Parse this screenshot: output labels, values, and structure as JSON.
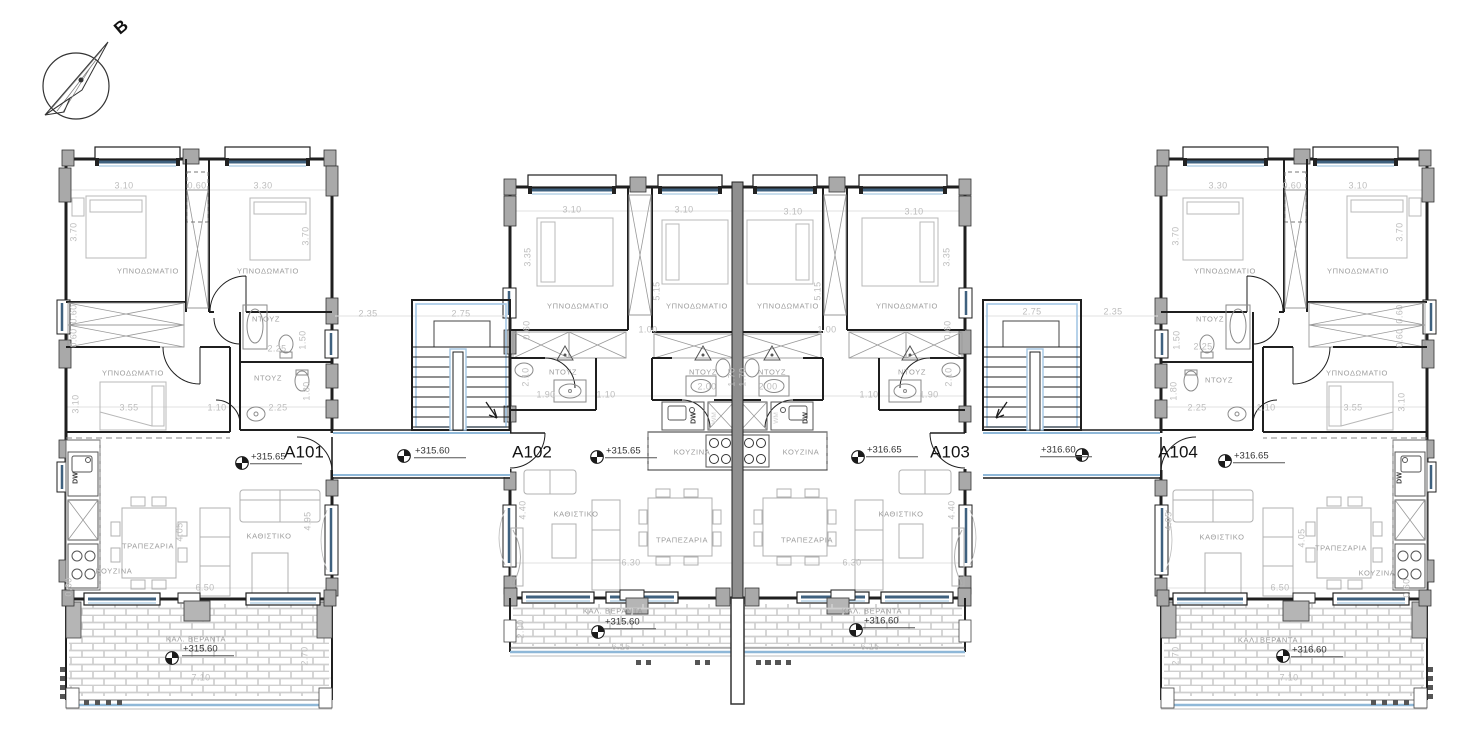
{
  "drawing": {
    "type": "architectural floor plan",
    "north_arrow_label": "B",
    "apartments": [
      {
        "id": "A101",
        "floor_level": "+315.65",
        "veranda_level": "+315.60"
      },
      {
        "id": "A102",
        "floor_level": "+315.65",
        "veranda_level": "+315.60"
      },
      {
        "id": "A103",
        "floor_level": "+316.65",
        "veranda_level": "+316.60"
      },
      {
        "id": "A104",
        "floor_level": "+316.65",
        "veranda_level": "+316.60"
      }
    ],
    "stairwells": [
      {
        "level": "+315.60"
      },
      {
        "level": "+316.60"
      }
    ],
    "room_names_used": [
      "ΥΠΝΟΔΩΜΑΤΙΟ",
      "ΝΤΟΥΖ",
      "ΚΟΥΖΙΝΑ",
      "ΤΡΑΠΕΖΑΡΙΑ",
      "ΚΑΘΙΣΤΙΚΟ",
      "ΚΑΛ. ΒΕΡΑΝΤΑ"
    ],
    "colors": {
      "wall": "#1f1f1f",
      "window_glazing": "#3f617f",
      "window_glazing_light": "#a9c9e2",
      "stair_outline": "#a3c6e4",
      "veranda_edge_blue": "#8fb8d8",
      "dimension_text": "#bdbdbd",
      "room_text": "#9c9c9c",
      "column_fill": "#a9a9a9"
    }
  },
  "labels": [
    {
      "t": "B",
      "x": 121,
      "y": 27,
      "c": "north"
    },
    {
      "t": "3.10",
      "x": 124,
      "y": 186,
      "c": "dim"
    },
    {
      "t": "0.60",
      "x": 197,
      "y": 186,
      "c": "dim"
    },
    {
      "t": "3.30",
      "x": 263,
      "y": 186,
      "c": "dim"
    },
    {
      "t": "3.70",
      "x": 74,
      "y": 232,
      "c": "dimv"
    },
    {
      "t": "3.70",
      "x": 306,
      "y": 236,
      "c": "dimv"
    },
    {
      "t": "ΥΠΝΟΔΩΜΑΤΙΟ",
      "x": 148,
      "y": 271,
      "c": "room"
    },
    {
      "t": "ΥΠΝΟΔΩΜΑΤΙΟ",
      "x": 268,
      "y": 271,
      "c": "room"
    },
    {
      "t": "ΝΤΟΥΖ",
      "x": 266,
      "y": 319,
      "c": "room"
    },
    {
      "t": "0.60",
      "x": 74,
      "y": 314,
      "c": "dimv"
    },
    {
      "t": "0.60",
      "x": 74,
      "y": 338,
      "c": "dimv"
    },
    {
      "t": "2.25",
      "x": 277,
      "y": 349,
      "c": "dim"
    },
    {
      "t": "1.50",
      "x": 303,
      "y": 340,
      "c": "dimv"
    },
    {
      "t": "ΥΠΝΟΔΩΜΑΤΙΟ",
      "x": 133,
      "y": 373,
      "c": "room"
    },
    {
      "t": "ΝΤΟΥΖ",
      "x": 268,
      "y": 378,
      "c": "room"
    },
    {
      "t": "3.55",
      "x": 129,
      "y": 408,
      "c": "dim"
    },
    {
      "t": "1.10",
      "x": 217,
      "y": 408,
      "c": "dim"
    },
    {
      "t": "2.25",
      "x": 278,
      "y": 408,
      "c": "dim"
    },
    {
      "t": "3.10",
      "x": 76,
      "y": 404,
      "c": "dimv"
    },
    {
      "t": "1.80",
      "x": 307,
      "y": 391,
      "c": "dimv"
    },
    {
      "t": "A101",
      "x": 304,
      "y": 452,
      "c": "apt"
    },
    {
      "t": "+315.65",
      "x": 250,
      "y": 458,
      "c": "level"
    },
    {
      "t": "ΤΡΑΠΕΖΑΡΙΑ",
      "x": 148,
      "y": 546,
      "c": "room"
    },
    {
      "t": "ΚΟΥΖΙΝΑ",
      "x": 114,
      "y": 571,
      "c": "room"
    },
    {
      "t": "ΚΑΘΙΣΤΙΚΟ",
      "x": 269,
      "y": 536,
      "c": "room"
    },
    {
      "t": "4.05",
      "x": 180,
      "y": 532,
      "c": "dimv"
    },
    {
      "t": "4.95",
      "x": 308,
      "y": 521,
      "c": "dimv"
    },
    {
      "t": "6.50",
      "x": 205,
      "y": 588,
      "c": "dim"
    },
    {
      "t": "0.60",
      "x": 69,
      "y": 587,
      "c": "dimv"
    },
    {
      "t": "DW",
      "x": 76,
      "y": 478,
      "c": "appl"
    },
    {
      "t": "ΚΑΛ. ΒΕΡΑΝΤΑ",
      "x": 196,
      "y": 639,
      "c": "room"
    },
    {
      "t": "+315.60",
      "x": 182,
      "y": 650,
      "c": "level"
    },
    {
      "t": "7.10",
      "x": 201,
      "y": 678,
      "c": "dim"
    },
    {
      "t": "2.70",
      "x": 305,
      "y": 656,
      "c": "dimv"
    },
    {
      "t": "2.35",
      "x": 368,
      "y": 314,
      "c": "dim"
    },
    {
      "t": "2.75",
      "x": 461,
      "y": 314,
      "c": "dim"
    },
    {
      "t": "+315.60",
      "x": 414,
      "y": 452,
      "c": "level"
    },
    {
      "t": "A102",
      "x": 532,
      "y": 452,
      "c": "apt"
    },
    {
      "t": "3.10",
      "x": 572,
      "y": 210,
      "c": "dim"
    },
    {
      "t": "3.10",
      "x": 684,
      "y": 210,
      "c": "dim"
    },
    {
      "t": "3.10",
      "x": 793,
      "y": 212,
      "c": "dim"
    },
    {
      "t": "3.10",
      "x": 914,
      "y": 212,
      "c": "dim"
    },
    {
      "t": "3.35",
      "x": 528,
      "y": 257,
      "c": "dimv"
    },
    {
      "t": "3.35",
      "x": 947,
      "y": 257,
      "c": "dimv"
    },
    {
      "t": "5.15",
      "x": 657,
      "y": 291,
      "c": "dimv"
    },
    {
      "t": "5.15",
      "x": 818,
      "y": 291,
      "c": "dimv"
    },
    {
      "t": "ΥΠΝΟΔΩΜΑΤΙΟ",
      "x": 578,
      "y": 306,
      "c": "room"
    },
    {
      "t": "ΥΠΝΟΔΩΜΑΤΙΟ",
      "x": 697,
      "y": 306,
      "c": "room"
    },
    {
      "t": "ΥΠΝΟΔΩΜΑΤΙΟ",
      "x": 788,
      "y": 306,
      "c": "room"
    },
    {
      "t": "ΥΠΝΟΔΩΜΑΤΙΟ",
      "x": 907,
      "y": 306,
      "c": "room"
    },
    {
      "t": "1.00",
      "x": 648,
      "y": 330,
      "c": "dim"
    },
    {
      "t": "1.00",
      "x": 827,
      "y": 330,
      "c": "dim"
    },
    {
      "t": "0.60",
      "x": 527,
      "y": 330,
      "c": "dimv"
    },
    {
      "t": "0.60",
      "x": 948,
      "y": 330,
      "c": "dimv"
    },
    {
      "t": "ΝΤΟΥΖ",
      "x": 563,
      "y": 372,
      "c": "room"
    },
    {
      "t": "ΝΤΟΥΖ",
      "x": 703,
      "y": 372,
      "c": "room"
    },
    {
      "t": "ΝΤΟΥΖ",
      "x": 772,
      "y": 372,
      "c": "room"
    },
    {
      "t": "ΝΤΟΥΖ",
      "x": 912,
      "y": 372,
      "c": "room"
    },
    {
      "t": "2.10",
      "x": 526,
      "y": 377,
      "c": "dimv"
    },
    {
      "t": "2.10",
      "x": 949,
      "y": 377,
      "c": "dimv"
    },
    {
      "t": "1.90",
      "x": 546,
      "y": 395,
      "c": "dim"
    },
    {
      "t": "1.90",
      "x": 929,
      "y": 395,
      "c": "dim"
    },
    {
      "t": "1.10",
      "x": 606,
      "y": 395,
      "c": "dim"
    },
    {
      "t": "1.10",
      "x": 869,
      "y": 395,
      "c": "dim"
    },
    {
      "t": "2.00",
      "x": 707,
      "y": 387,
      "c": "dim"
    },
    {
      "t": "2.00",
      "x": 768,
      "y": 387,
      "c": "dim"
    },
    {
      "t": "1.70",
      "x": 732,
      "y": 377,
      "c": "dimv"
    },
    {
      "t": "1.70",
      "x": 743,
      "y": 377,
      "c": "dimv"
    },
    {
      "t": "DW",
      "x": 694,
      "y": 418,
      "c": "appl"
    },
    {
      "t": "DW",
      "x": 806,
      "y": 418,
      "c": "appl"
    },
    {
      "t": "WM",
      "x": 715,
      "y": 418,
      "c": "applf"
    },
    {
      "t": "WM",
      "x": 777,
      "y": 418,
      "c": "applf"
    },
    {
      "t": "ΚΟΥΖΙΝΑ",
      "x": 692,
      "y": 452,
      "c": "room"
    },
    {
      "t": "ΚΟΥΖΙΝΑ",
      "x": 801,
      "y": 452,
      "c": "room"
    },
    {
      "t": "+315.65",
      "x": 605,
      "y": 452,
      "c": "level"
    },
    {
      "t": "+316.65",
      "x": 866,
      "y": 451,
      "c": "level"
    },
    {
      "t": "A103",
      "x": 950,
      "y": 452,
      "c": "apt"
    },
    {
      "t": "ΚΑΘΙΣΤΙΚΟ",
      "x": 576,
      "y": 514,
      "c": "room"
    },
    {
      "t": "ΚΑΘΙΣΤΙΚΟ",
      "x": 901,
      "y": 514,
      "c": "room"
    },
    {
      "t": "4.40",
      "x": 523,
      "y": 510,
      "c": "dimv"
    },
    {
      "t": "4.40",
      "x": 952,
      "y": 510,
      "c": "dimv"
    },
    {
      "t": "ΤΡΑΠΕΖΑΡΙΑ",
      "x": 682,
      "y": 540,
      "c": "room"
    },
    {
      "t": "ΤΡΑΠΕΖΑΡΙΑ",
      "x": 807,
      "y": 540,
      "c": "room"
    },
    {
      "t": "6.30",
      "x": 631,
      "y": 563,
      "c": "dim"
    },
    {
      "t": "6.30",
      "x": 852,
      "y": 563,
      "c": "dim"
    },
    {
      "t": "ΚΑΛ. ΒΕΡΑΝΤΑ",
      "x": 613,
      "y": 611,
      "c": "room"
    },
    {
      "t": "+315.60",
      "x": 604,
      "y": 623,
      "c": "level"
    },
    {
      "t": "6.15",
      "x": 621,
      "y": 647,
      "c": "dim"
    },
    {
      "t": "2.00",
      "x": 521,
      "y": 629,
      "c": "dimv"
    },
    {
      "t": "ΚΑΛ. ΒΕΡΑΝΤΑ",
      "x": 872,
      "y": 611,
      "c": "room"
    },
    {
      "t": "+316.60",
      "x": 863,
      "y": 622,
      "c": "level"
    },
    {
      "t": "6.15",
      "x": 870,
      "y": 647,
      "c": "dim"
    },
    {
      "t": "2.75",
      "x": 1032,
      "y": 312,
      "c": "dim"
    },
    {
      "t": "2.35",
      "x": 1113,
      "y": 312,
      "c": "dim"
    },
    {
      "t": "+316.60",
      "x": 1040,
      "y": 451,
      "c": "level"
    },
    {
      "t": "A104",
      "x": 1178,
      "y": 452,
      "c": "apt"
    },
    {
      "t": "3.30",
      "x": 1218,
      "y": 186,
      "c": "dim"
    },
    {
      "t": "0.60",
      "x": 1292,
      "y": 186,
      "c": "dim"
    },
    {
      "t": "3.10",
      "x": 1358,
      "y": 186,
      "c": "dim"
    },
    {
      "t": "3.70",
      "x": 1176,
      "y": 236,
      "c": "dimv"
    },
    {
      "t": "3.70",
      "x": 1400,
      "y": 232,
      "c": "dimv"
    },
    {
      "t": "ΥΠΝΟΔΩΜΑΤΙΟ",
      "x": 1225,
      "y": 271,
      "c": "room"
    },
    {
      "t": "ΥΠΝΟΔΩΜΑΤΙΟ",
      "x": 1358,
      "y": 271,
      "c": "room"
    },
    {
      "t": "ΝΤΟΥΖ",
      "x": 1210,
      "y": 319,
      "c": "room"
    },
    {
      "t": "0.60",
      "x": 1400,
      "y": 314,
      "c": "dimv"
    },
    {
      "t": "0.60",
      "x": 1400,
      "y": 338,
      "c": "dimv"
    },
    {
      "t": "2.25",
      "x": 1203,
      "y": 347,
      "c": "dim"
    },
    {
      "t": "1.50",
      "x": 1177,
      "y": 340,
      "c": "dimv"
    },
    {
      "t": "ΥΠΝΟΔΩΜΑΤΙΟ",
      "x": 1357,
      "y": 373,
      "c": "room"
    },
    {
      "t": "ΝΤΟΥΖ",
      "x": 1219,
      "y": 380,
      "c": "room"
    },
    {
      "t": "2.25",
      "x": 1197,
      "y": 408,
      "c": "dim"
    },
    {
      "t": "1.10",
      "x": 1266,
      "y": 408,
      "c": "dim"
    },
    {
      "t": "3.55",
      "x": 1353,
      "y": 408,
      "c": "dim"
    },
    {
      "t": "3.10",
      "x": 1402,
      "y": 402,
      "c": "dimv"
    },
    {
      "t": "1.80",
      "x": 1174,
      "y": 391,
      "c": "dimv"
    },
    {
      "t": "+316.65",
      "x": 1233,
      "y": 457,
      "c": "level"
    },
    {
      "t": "ΚΑΘΙΣΤΙΚΟ",
      "x": 1222,
      "y": 537,
      "c": "room"
    },
    {
      "t": "ΤΡΑΠΕΖΑΡΙΑ",
      "x": 1341,
      "y": 548,
      "c": "room"
    },
    {
      "t": "ΚΟΥΖΙΝΑ",
      "x": 1377,
      "y": 573,
      "c": "room"
    },
    {
      "t": "4.95",
      "x": 1169,
      "y": 521,
      "c": "dimv"
    },
    {
      "t": "4.05",
      "x": 1302,
      "y": 538,
      "c": "dimv"
    },
    {
      "t": "6.50",
      "x": 1280,
      "y": 588,
      "c": "dim"
    },
    {
      "t": "0.60",
      "x": 1407,
      "y": 588,
      "c": "dimv"
    },
    {
      "t": "DW",
      "x": 1400,
      "y": 478,
      "c": "appl"
    },
    {
      "t": "ΚΑΛ. ΒΕΡΑΝΤΑ",
      "x": 1268,
      "y": 640,
      "c": "room"
    },
    {
      "t": "+316.60",
      "x": 1291,
      "y": 651,
      "c": "level"
    },
    {
      "t": "7.10",
      "x": 1289,
      "y": 678,
      "c": "dim"
    },
    {
      "t": "2.70",
      "x": 1176,
      "y": 656,
      "c": "dimv"
    }
  ]
}
